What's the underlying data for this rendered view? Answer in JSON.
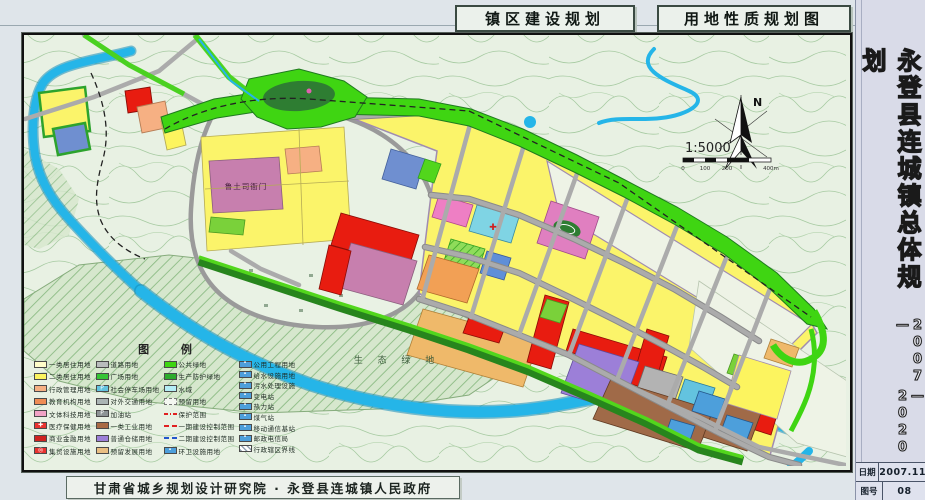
{
  "header": {
    "plan_label": "镇区建设规划",
    "map_label": "用地性质规划图"
  },
  "sidebar": {
    "title": "永登县连城镇总体规划",
    "years_first": "2007—",
    "years_second": "—2020",
    "info": [
      {
        "label": "日期",
        "value": "2007.11"
      },
      {
        "label": "图号",
        "value": "08"
      }
    ]
  },
  "footer": {
    "credit": "甘肃省城乡规划设计研究院 · 永登县连城镇人民政府"
  },
  "map": {
    "compass": "N",
    "scale_text": "1:5000",
    "scale_ticks": [
      "0",
      "100",
      "200",
      "400m"
    ],
    "labels": {
      "historic_site": "鲁土司衙门",
      "eco_green": "生 态 绿 地"
    },
    "legend": {
      "title": "图 例",
      "columns": [
        [
          {
            "label": "一类居住用地",
            "color": "#fffdc9"
          },
          {
            "label": "二类居住用地",
            "color": "#fcf45f"
          },
          {
            "label": "行政管理用地",
            "color": "#f6b083"
          },
          {
            "label": "教育机构用地",
            "color": "#ef8d55"
          },
          {
            "label": "文体科技用地",
            "color": "#f1a3c6"
          },
          {
            "label": "医疗保健用地",
            "color": "#e93330",
            "glyph": "✚"
          },
          {
            "label": "商业金融用地",
            "color": "#ce241f"
          },
          {
            "label": "集贸设施用地",
            "color": "#e93330",
            "glyph": "◎"
          }
        ],
        [
          {
            "label": "道路用地",
            "color": "#b9bcbd"
          },
          {
            "label": "广场用地",
            "color": "#35c435"
          },
          {
            "label": "社会停车场用地",
            "color": "#63c3df",
            "glyph": "P"
          },
          {
            "label": "对外交通用地",
            "color": "#aab4b4"
          },
          {
            "label": "加油站",
            "color": "#8e9496",
            "glyph": "P"
          },
          {
            "label": "一类工业用地",
            "color": "#a96a44"
          },
          {
            "label": "普通仓储用地",
            "color": "#9c7fd8"
          },
          {
            "label": "预留发展用地",
            "color": "#e9bf83"
          }
        ],
        [
          {
            "label": "公共绿地",
            "color": "#3fd512"
          },
          {
            "label": "生产防护绿地",
            "color": "#2dab2d"
          },
          {
            "label": "水域",
            "color": "#b4eef6"
          },
          {
            "label": "预留用地",
            "kind": "box-dash"
          },
          {
            "label": "保护范围",
            "kind": "line-reddashdot"
          },
          {
            "label": "一期建设控制范围",
            "kind": "line-red"
          },
          {
            "label": "二期建设控制范围",
            "kind": "line-blue"
          },
          {
            "label": "环卫设施用地",
            "color": "#4d9fdb",
            "glyph": "•"
          }
        ],
        [
          {
            "label": "公用工程用地",
            "color": "#4d9fdb",
            "glyph": "•"
          },
          {
            "label": "给水设施用地",
            "color": "#4d9fdb",
            "glyph": "•"
          },
          {
            "label": "污水处理设施",
            "color": "#4d9fdb",
            "glyph": "•"
          },
          {
            "label": "变电站",
            "color": "#4d9fdb",
            "glyph": "•"
          },
          {
            "label": "热力站",
            "color": "#4d9fdb",
            "glyph": "•"
          },
          {
            "label": "煤气站",
            "color": "#4d9fdb",
            "glyph": "•"
          },
          {
            "label": "移动通信基站",
            "color": "#4d9fdb",
            "glyph": "•"
          },
          {
            "label": "邮政电信局",
            "color": "#4d9fdb",
            "glyph": "•"
          },
          {
            "label": "行政辖区界线",
            "kind": "box-hatch"
          }
        ]
      ]
    }
  },
  "palette": {
    "page_bg": "#dfe5ea",
    "sidebar_bg": "#d9dbe8",
    "map_bg": "#e8f1e3",
    "contour_green": "#a3c89e",
    "river_blue": "#25b5e8",
    "bright_green": "#3fd512",
    "belt_dark_green": "#1f7a1f",
    "forest_green": "#2e7d32",
    "residential_yellow": "#fbf46a",
    "commercial_red": "#e81c10",
    "historic_mauve": "#c77fae",
    "culture_pink": "#ee7fc4",
    "education_orange": "#f2a055",
    "industry_brown": "#a06a48",
    "warehouse_purple": "#9c7fd8",
    "utility_blue": "#4d9fdb",
    "road_gray": "#ababab"
  }
}
